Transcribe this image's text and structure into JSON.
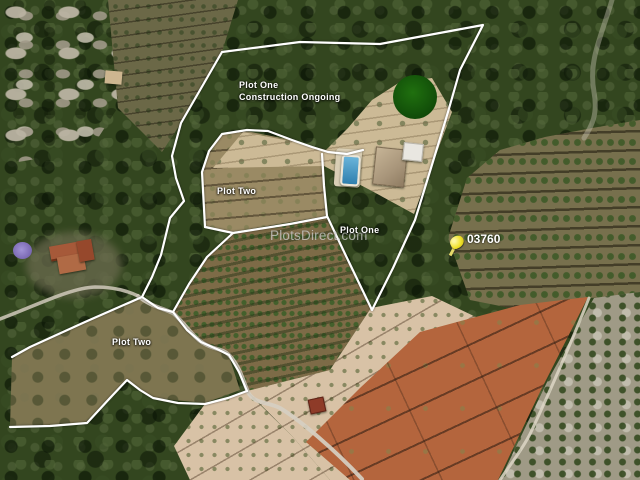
{
  "map": {
    "watermark": "PlotsDirect.com",
    "labels": {
      "plot_one_construction": {
        "line1": "Plot One",
        "line2": "Construction Ongoing"
      },
      "plot_two_upper": "Plot Two",
      "plot_one_mid": "Plot One",
      "plot_two_lower": "Plot Two"
    },
    "marker": {
      "label": "03760",
      "icon": "yellow-pushpin"
    },
    "colors": {
      "boundary_line": "#ffffff",
      "marker_yellow": "#f0e63c",
      "status_circle_green": "#14540a",
      "pool_blue": "#4a9cc8"
    }
  }
}
